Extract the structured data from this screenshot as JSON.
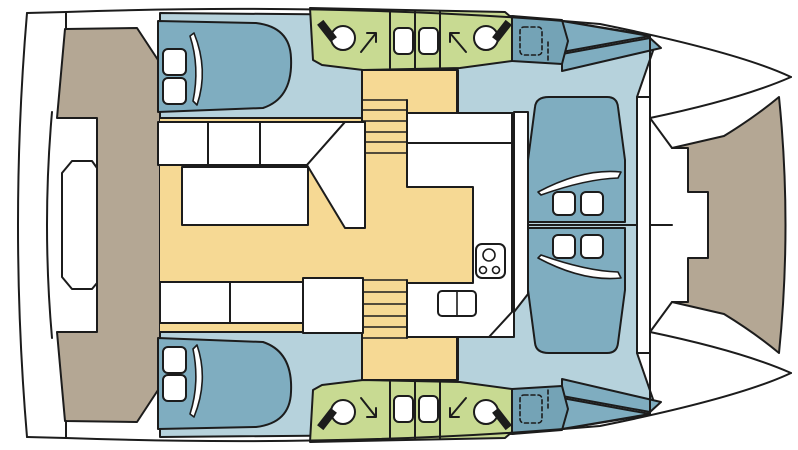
{
  "diagram": {
    "kind": "catamaran-deck-floor-plan",
    "orientation": {
      "bow": "right",
      "stern": "left"
    },
    "symmetry": "mirrored-top-bottom"
  },
  "palette": {
    "outline": "#1c1c1c",
    "hull_white": "#ffffff",
    "deck_tan": "#b4a794",
    "saloon_yellow": "#f6d994",
    "interior_blue": "#b6d2dc",
    "furniture_teal": "#7fadc0",
    "bathroom_green": "#c8da92",
    "hatch_teal": "#74a3b6",
    "fixture_white": "#ffffff"
  },
  "rooms": {
    "aft_platform": "transom platform",
    "aft_deck": "aft deck",
    "saloon": "saloon with dinette",
    "galley": "galley",
    "cabin_port": "double cabin (top hull)",
    "cabin_starboard": "double cabin (bottom hull)",
    "bathroom_port": "bathroom (top hull)",
    "bathroom_starboard": "bathroom (bottom hull)",
    "forward_lounge": "forward lounge",
    "foredeck": "foredeck",
    "bow_port": "port bow",
    "bow_starboard": "starboard bow"
  },
  "fixtures": {
    "toilets": 4,
    "shower_arrows": 4,
    "washbasins": 4,
    "double_berths": 2,
    "berth_pillows": 4,
    "lounger_pillows": 4,
    "sun_loungers": 2,
    "stair_flights": 2,
    "stove_burners": 3,
    "galley_sink_bowls": 2,
    "deck_hatches": 2,
    "saloon_table": 1,
    "settee_seats": 3,
    "bench_seats": 2
  }
}
